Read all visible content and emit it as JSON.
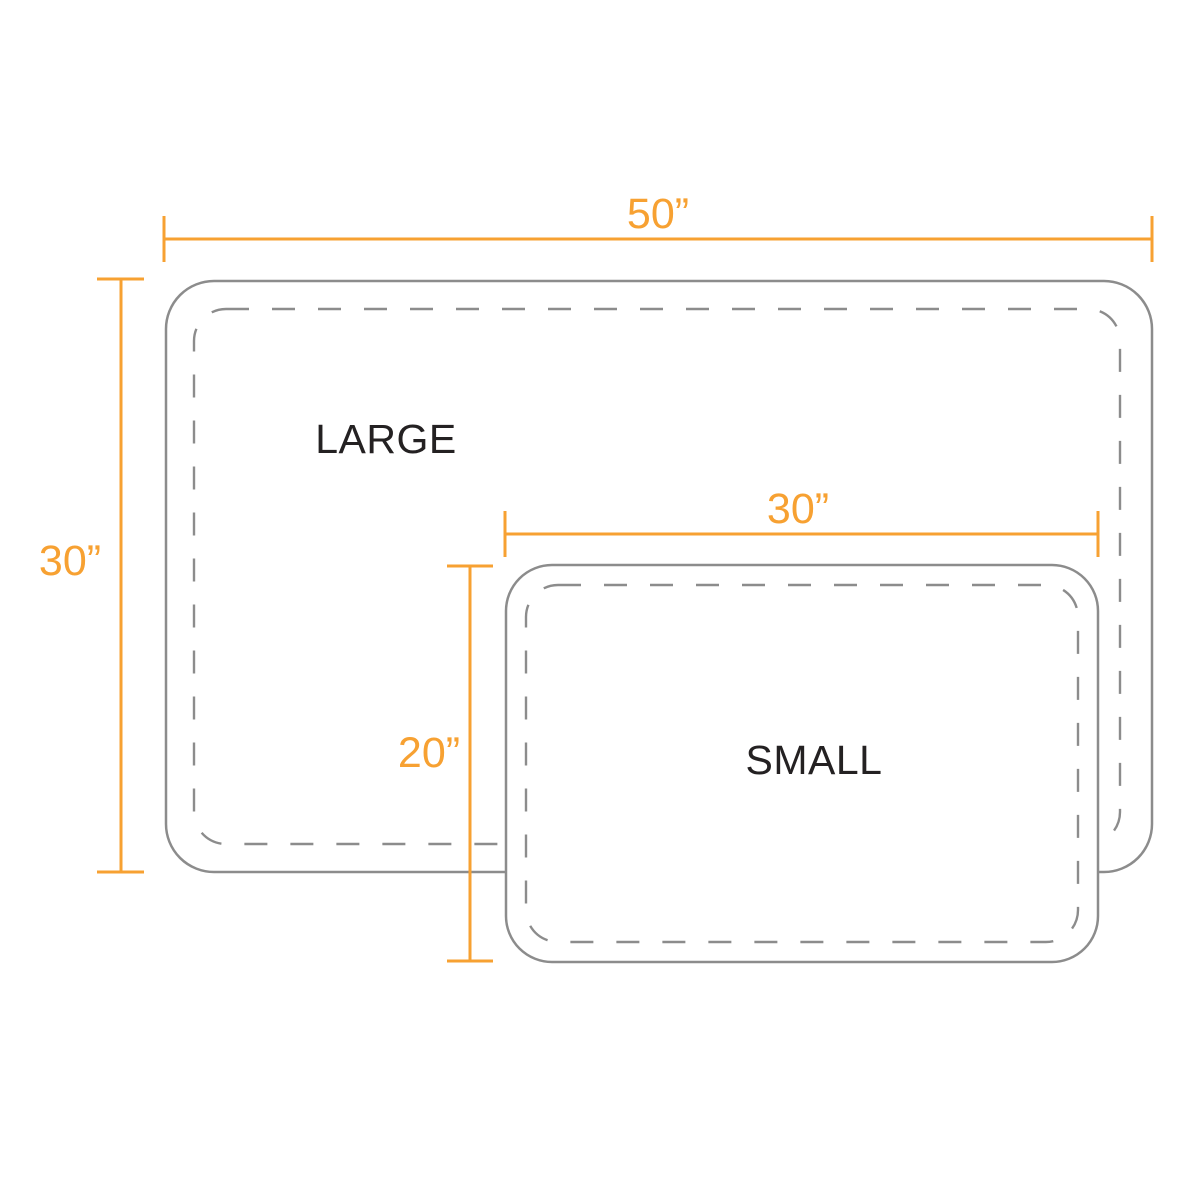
{
  "diagram": {
    "mats": [
      {
        "name": "LARGE",
        "width_label": "50”",
        "height_label": "30”",
        "width_in": 50,
        "height_in": 30
      },
      {
        "name": "SMALL",
        "width_label": "30”",
        "height_label": "20”",
        "width_in": 30,
        "height_in": 20
      }
    ],
    "colors": {
      "dimension_line": "#F7A132",
      "shape_outline": "#8C8C8C",
      "label_text": "#242122",
      "background": "#FFFFFF"
    }
  }
}
